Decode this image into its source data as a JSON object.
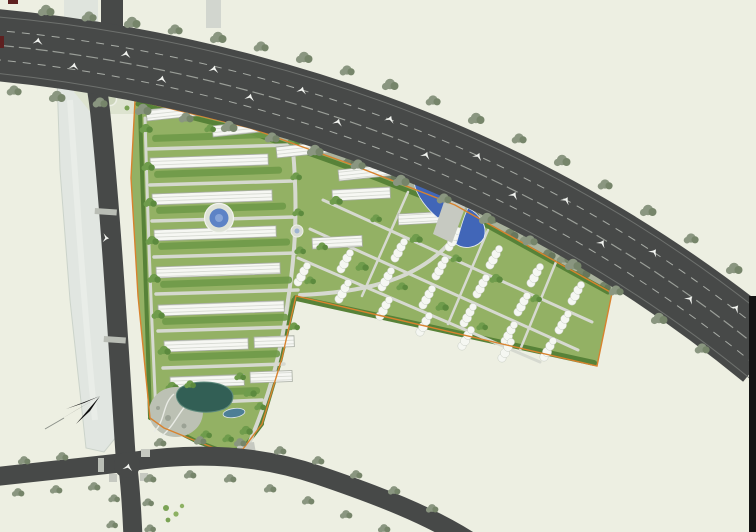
{
  "meta": {
    "image_type": "architectural master-plan site rendering (aerial plan view)",
    "visible_text": "none (no legible labels in image)"
  },
  "palette": {
    "bg": "#edefe2",
    "road": "#474948",
    "road_edge": "#6e716e",
    "lane": "#a8aca6",
    "median": "#9a9e98",
    "crossing": "#b9bdb5",
    "canal": "#e1e6e1",
    "canal_edge": "#cbd3ca",
    "site": "#93b164",
    "buffer": "#a9b29d",
    "tree_gray": "#8a9680",
    "tree_gray_dark": "#76856a",
    "tree_green": "#5c8a3e",
    "tree_green2": "#6f9c4c",
    "hedge": "#6f9a48",
    "hedge_dark": "#578238",
    "iroad": "#d6d9d0",
    "slab_stroke": "#a9aea4",
    "slab_fill": "#f6f7f3",
    "slab_line": "#d8dbd4",
    "villa": "#f5f7f2",
    "boundary": "#d8822e",
    "pool": "#5d83c6",
    "water": "#4166b8",
    "pond": "#325f55",
    "rock": "#bcc1b4",
    "park": "#dde3cf",
    "park_circle": "#ccd5bb",
    "car": "#f2f4f0",
    "border_strip": "#141414",
    "border_mark": "#5e2020"
  },
  "features": {
    "arterial_road": {
      "name": "curved arterial road",
      "position": "sweeps from top-left to right edge",
      "cars_visible": 17,
      "tree_lined": true
    },
    "canal": {
      "name": "canal / waterway",
      "position": "left side, vertical"
    },
    "canal_road": {
      "name": "canal-side road",
      "position": "left side, vertical"
    },
    "south_roads": {
      "name": "secondary road intersection",
      "position": "bottom-left crossroads with curved east branch"
    },
    "compound": {
      "name": "residential compound",
      "shape": "wedge with left slab-building column and right villa wing",
      "boundary_color": "orange"
    },
    "slab_buildings": {
      "count_rows": 11,
      "color": "white"
    },
    "villa_clusters": {
      "count": 21,
      "color": "white"
    },
    "circular_pool_plaza": {
      "position": "center-left of compound",
      "color": "blue"
    },
    "entrance_water_feature": {
      "position": "north entrance off arterial road",
      "color": "blue"
    },
    "south_pond": {
      "position": "compound south tip",
      "color": "dark teal"
    },
    "rock_garden": {
      "position": "compound south-west tip",
      "color": "gray"
    },
    "small_park": {
      "position": "top-left between road fork and compound",
      "detail": "three circular lawns"
    },
    "north_arrow": {
      "position": "lower-left over canal",
      "color": "black"
    }
  }
}
